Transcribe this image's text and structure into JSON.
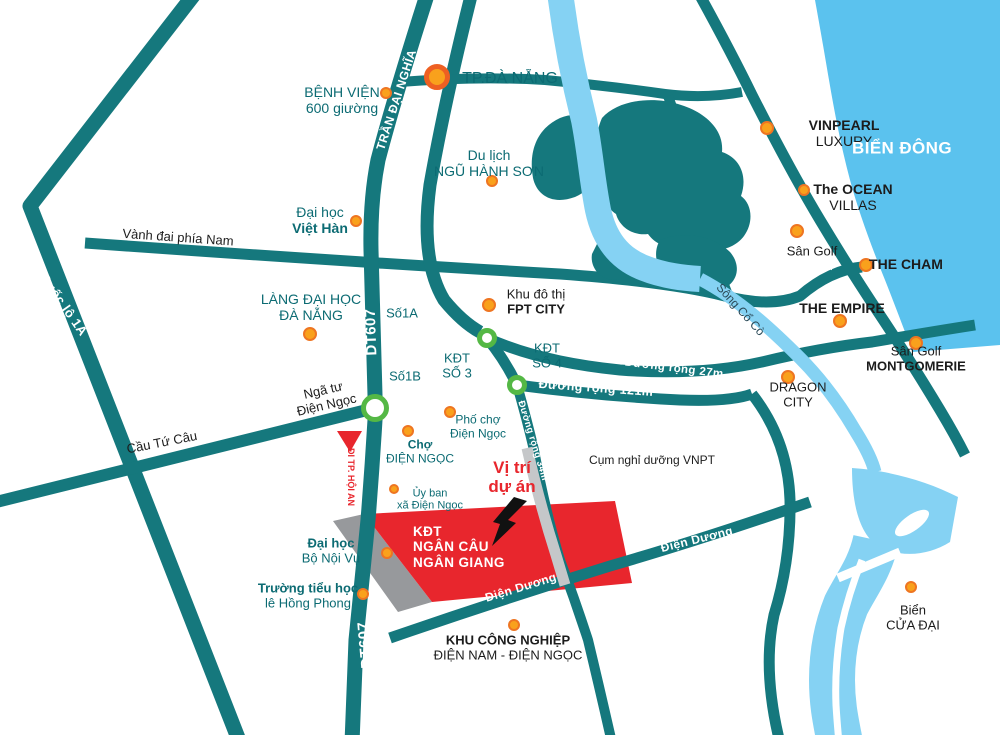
{
  "map": {
    "title": "Ngan Cau Ngan Giang project location map",
    "colors": {
      "road_teal": "#15787d",
      "river_blue": "#85d2f3",
      "sea_blue": "#5bc2ee",
      "label_teal": "#0c6b73",
      "label_black": "#1c1c1c",
      "project_red": "#e8262d",
      "gray_dark": "#97999c",
      "gray_light": "#c5c7c9",
      "poi_orange_fill": "#f9a11c",
      "poi_orange_ring": "#ee7522",
      "junction_green": "#54b845",
      "road_label_white": "#ffffff"
    },
    "labels": [
      {
        "id": "road-label-quoc-lo-1a-top",
        "lines": [
          "Quốc lộ 1A"
        ],
        "x": 100,
        "y": 92,
        "rot": -52,
        "cls": "lbl-white",
        "size": 13
      },
      {
        "id": "road-label-quoc-lo-1a-mid",
        "lines": [
          "Quốc lộ 1A"
        ],
        "x": 63,
        "y": 305,
        "rot": 55,
        "cls": "lbl-white",
        "size": 13
      },
      {
        "id": "road-label-quoc-lo-1a-bottom",
        "lines": [
          "Quốc lộ 1A"
        ],
        "x": 153,
        "y": 597,
        "rot": 55,
        "cls": "lbl-white",
        "size": 13
      },
      {
        "id": "road-label-tran-dai-nghia",
        "lines": [
          "TRẦN ĐẠI NGHĨA"
        ],
        "x": 397,
        "y": 100,
        "rot": -72,
        "cls": "lbl-white",
        "size": 12
      },
      {
        "id": "road-label-dt607-upper",
        "lines": [
          "DT607"
        ],
        "x": 372,
        "y": 332,
        "rot": -92,
        "cls": "lbl-white",
        "size": 15
      },
      {
        "id": "road-label-dt607-lower",
        "lines": [
          "DT607"
        ],
        "x": 366,
        "y": 645,
        "rot": -95,
        "cls": "lbl-white",
        "size": 15
      },
      {
        "id": "road-label-duong-truong-sa",
        "lines": [
          "Đường Trường Sa"
        ],
        "x": 806,
        "y": 226,
        "rot": 57,
        "cls": "lbl-white",
        "size": 11
      },
      {
        "id": "road-label-duong-rong-27m",
        "lines": [
          "Đường rộng 27m"
        ],
        "x": 674,
        "y": 369,
        "rot": 7,
        "cls": "lbl-white",
        "size": 11.5
      },
      {
        "id": "road-label-duong-rong-121m",
        "lines": [
          "Đường rộng 121m"
        ],
        "x": 596,
        "y": 388,
        "rot": 4,
        "cls": "lbl-white",
        "size": 12.5
      },
      {
        "id": "road-label-duong-rong-34m",
        "lines": [
          "Đường rộng 34m"
        ],
        "x": 532,
        "y": 441,
        "rot": 73,
        "cls": "lbl-white",
        "size": 9.5
      },
      {
        "id": "road-label-dien-duong-west",
        "lines": [
          "Điện Dương"
        ],
        "x": 521,
        "y": 588,
        "rot": -17,
        "cls": "lbl-white",
        "size": 12
      },
      {
        "id": "road-label-dien-duong-east",
        "lines": [
          "Điện Dương"
        ],
        "x": 697,
        "y": 540,
        "rot": -14,
        "cls": "lbl-white",
        "size": 12
      },
      {
        "id": "label-benh-vien",
        "lines": [
          "BỆNH VIỆN",
          "600 giường"
        ],
        "x": 342,
        "y": 101,
        "cls": "lbl-teal",
        "size": 14
      },
      {
        "id": "label-tp-da-nang",
        "lines": [
          "TP.ĐÀ NẴNG"
        ],
        "x": 510,
        "y": 79,
        "cls": "lbl-teal",
        "size": 16
      },
      {
        "id": "label-du-lich-ngu-hanh-son",
        "lines": [
          "Du lịch",
          "NGŨ HÀNH SƠN"
        ],
        "x": 489,
        "y": 164,
        "cls": "lbl-teal",
        "size": 14
      },
      {
        "id": "label-vinpearl-luxury",
        "lines": [
          "VINPEARL",
          "LUXURY"
        ],
        "x": 844,
        "y": 134,
        "cls": "lbl-black",
        "size": 14,
        "bold": [
          0
        ]
      },
      {
        "id": "label-bien-dong",
        "lines": [
          "BIỂN ĐÔNG"
        ],
        "x": 902,
        "y": 148,
        "cls": "lbl-white",
        "size": 17
      },
      {
        "id": "label-the-ocean-villas",
        "lines": [
          "The OCEAN",
          "VILLAS"
        ],
        "x": 853,
        "y": 198,
        "cls": "lbl-black",
        "size": 14,
        "bold": [
          0
        ]
      },
      {
        "id": "label-san-golf-north",
        "lines": [
          "Sân Golf"
        ],
        "x": 812,
        "y": 252,
        "cls": "lbl-black",
        "size": 13
      },
      {
        "id": "label-the-cham",
        "lines": [
          "THE CHAM"
        ],
        "x": 906,
        "y": 265,
        "cls": "lbl-black",
        "size": 14,
        "bold": true
      },
      {
        "id": "label-the-empire",
        "lines": [
          "THE EMPIRE"
        ],
        "x": 842,
        "y": 309,
        "cls": "lbl-black",
        "size": 14,
        "bold": true
      },
      {
        "id": "label-san-golf-montgomerie",
        "lines": [
          "Sân Golf",
          "MONTGOMERIE"
        ],
        "x": 916,
        "y": 359,
        "cls": "lbl-black",
        "size": 13,
        "bold": [
          1
        ]
      },
      {
        "id": "label-dai-hoc-viet-han",
        "lines": [
          "Đại học",
          "Việt Hàn"
        ],
        "x": 320,
        "y": 221,
        "cls": "lbl-teal",
        "size": 14,
        "bold": [
          1
        ]
      },
      {
        "id": "label-vanh-dai-phia-nam",
        "lines": [
          "Vành đai phía Nam"
        ],
        "x": 178,
        "y": 238,
        "rot": 4,
        "cls": "lbl-black",
        "size": 13
      },
      {
        "id": "label-lang-dai-hoc-da-nang",
        "lines": [
          "LÀNG ĐẠI HỌC",
          "ĐÀ NẴNG"
        ],
        "x": 311,
        "y": 308,
        "cls": "lbl-teal",
        "size": 14
      },
      {
        "id": "label-khu-do-thi-fpt-city",
        "lines": [
          "Khu đô thị",
          "FPT CITY"
        ],
        "x": 536,
        "y": 302,
        "cls": "lbl-black",
        "size": 13,
        "bold": [
          1
        ]
      },
      {
        "id": "label-so-1a",
        "lines": [
          "Số1A"
        ],
        "x": 402,
        "y": 314,
        "cls": "lbl-teal",
        "size": 13
      },
      {
        "id": "label-so-1b",
        "lines": [
          "Số1B"
        ],
        "x": 405,
        "y": 377,
        "cls": "lbl-teal",
        "size": 13
      },
      {
        "id": "label-kdt-so-3",
        "lines": [
          "KĐT",
          "SỐ 3"
        ],
        "x": 457,
        "y": 366,
        "cls": "lbl-teal",
        "size": 13
      },
      {
        "id": "label-kdt-so-4",
        "lines": [
          "KĐT",
          "SỐ 4"
        ],
        "x": 547,
        "y": 356,
        "cls": "lbl-teal",
        "size": 13
      },
      {
        "id": "label-song-co-co",
        "lines": [
          "Sông Cổ Cò"
        ],
        "x": 740,
        "y": 310,
        "rot": 48,
        "cls": "lbl-slate",
        "size": 12
      },
      {
        "id": "label-dragon-city",
        "lines": [
          "DRAGON",
          "CITY"
        ],
        "x": 798,
        "y": 395,
        "cls": "lbl-black",
        "size": 13
      },
      {
        "id": "label-nga-tu-dien-ngoc",
        "lines": [
          "Ngã tư",
          "Điện Ngọc"
        ],
        "x": 325,
        "y": 398,
        "rot": -13,
        "cls": "lbl-black",
        "size": 13
      },
      {
        "id": "label-cau-tu-cau",
        "lines": [
          "Cầu Tứ Câu"
        ],
        "x": 162,
        "y": 443,
        "rot": -11,
        "cls": "lbl-black",
        "size": 13
      },
      {
        "id": "label-di-tp-hoi-an",
        "lines": [
          "ĐI TP. HỘI AN"
        ],
        "x": 351,
        "y": 477,
        "rot": 90,
        "cls": "lbl-red",
        "size": 9
      },
      {
        "id": "label-pho-cho-dien-ngoc",
        "lines": [
          "Phố chợ",
          "Điện Ngọc"
        ],
        "x": 478,
        "y": 427,
        "cls": "lbl-teal",
        "size": 12
      },
      {
        "id": "label-cho-dien-ngoc",
        "lines": [
          "Chợ",
          "ĐIỆN NGỌC"
        ],
        "x": 420,
        "y": 452,
        "cls": "lbl-teal",
        "size": 12,
        "bold": [
          0
        ]
      },
      {
        "id": "label-vi-tri-du-an",
        "lines": [
          "Vị trí",
          "dự án"
        ],
        "x": 512,
        "y": 477,
        "cls": "lbl-red",
        "size": 17
      },
      {
        "id": "label-cum-nghi-duong-vnpt",
        "lines": [
          "Cụm nghỉ dưỡng VNPT"
        ],
        "x": 652,
        "y": 461,
        "cls": "lbl-black",
        "size": 12
      },
      {
        "id": "label-uy-ban-xa-dien-ngoc",
        "lines": [
          "Ủy ban",
          "xã Điện Ngọc"
        ],
        "x": 430,
        "y": 500,
        "cls": "lbl-teal",
        "size": 11
      },
      {
        "id": "label-kdt-ngan-cau-ngan-giang",
        "lines": [
          "KĐT",
          "NGÂN CÂU",
          "NGÂN GIANG"
        ],
        "x": 413,
        "y": 547,
        "cls": "lbl-white lbl-left",
        "size": 13.5,
        "anchor": "left"
      },
      {
        "id": "label-dai-hoc-bo-noi-vu",
        "lines": [
          "Đại học",
          "Bộ Nội Vụ"
        ],
        "x": 331,
        "y": 551,
        "cls": "lbl-teal",
        "size": 13,
        "bold": [
          0
        ]
      },
      {
        "id": "label-truong-tieu-hoc",
        "lines": [
          "Trường tiểu học",
          "lê Hồng Phong"
        ],
        "x": 308,
        "y": 596,
        "cls": "lbl-teal",
        "size": 13,
        "bold": [
          0
        ]
      },
      {
        "id": "label-khu-cong-nghiep",
        "lines": [
          "KHU CÔNG NGHIỆP",
          "ĐIỆN NAM - ĐIỆN NGỌC"
        ],
        "x": 508,
        "y": 648,
        "cls": "lbl-black",
        "size": 13,
        "bold": [
          0
        ]
      },
      {
        "id": "label-bien-cua-dai",
        "lines": [
          "Biển",
          "CỬA ĐẠI"
        ],
        "x": 913,
        "y": 618,
        "cls": "lbl-black",
        "size": 13
      }
    ],
    "poi_dots": [
      {
        "id": "tp-da-nang-dot",
        "x": 437,
        "y": 77,
        "r": 13,
        "big": true
      },
      {
        "id": "benh-vien-dot",
        "x": 386,
        "y": 93,
        "r": 6
      },
      {
        "id": "ngu-hanh-son-dot",
        "x": 492,
        "y": 181,
        "r": 6
      },
      {
        "id": "vinpearl-dot",
        "x": 767,
        "y": 128,
        "r": 7
      },
      {
        "id": "ocean-villas-dot",
        "x": 804,
        "y": 190,
        "r": 6
      },
      {
        "id": "san-golf-north-dot",
        "x": 797,
        "y": 231,
        "r": 7
      },
      {
        "id": "the-cham-dot",
        "x": 866,
        "y": 265,
        "r": 7
      },
      {
        "id": "the-empire-dot",
        "x": 840,
        "y": 321,
        "r": 7
      },
      {
        "id": "montgomerie-dot",
        "x": 916,
        "y": 343,
        "r": 7
      },
      {
        "id": "viet-han-dot",
        "x": 356,
        "y": 221,
        "r": 6
      },
      {
        "id": "lang-dai-hoc-dot",
        "x": 310,
        "y": 334,
        "r": 7
      },
      {
        "id": "fpt-city-dot",
        "x": 489,
        "y": 305,
        "r": 7
      },
      {
        "id": "dragon-city-dot",
        "x": 788,
        "y": 377,
        "r": 7
      },
      {
        "id": "pho-cho-dot",
        "x": 450,
        "y": 412,
        "r": 6
      },
      {
        "id": "cho-dien-ngoc-dot",
        "x": 408,
        "y": 431,
        "r": 6
      },
      {
        "id": "uy-ban-dot",
        "x": 394,
        "y": 489,
        "r": 5
      },
      {
        "id": "bo-noi-vu-dot",
        "x": 387,
        "y": 553,
        "r": 6
      },
      {
        "id": "tieu-hoc-dot",
        "x": 363,
        "y": 594,
        "r": 6
      },
      {
        "id": "khu-cong-nghiep-dot",
        "x": 514,
        "y": 625,
        "r": 6
      },
      {
        "id": "cua-dai-dot",
        "x": 911,
        "y": 587,
        "r": 6
      }
    ],
    "junctions": [
      {
        "id": "nga-tu-dien-ngoc-junction",
        "x": 375,
        "y": 408,
        "r": 14
      },
      {
        "id": "fpt-city-junction",
        "x": 487,
        "y": 338,
        "r": 10
      },
      {
        "id": "duong-121m-junction",
        "x": 517,
        "y": 385,
        "r": 10
      }
    ]
  }
}
